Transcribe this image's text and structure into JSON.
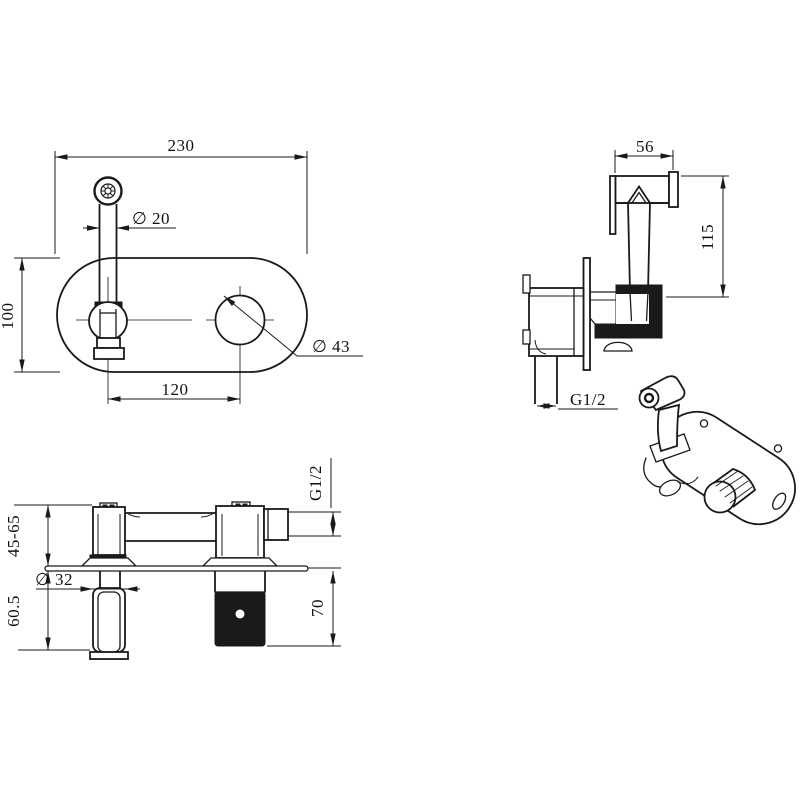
{
  "drawing": {
    "ink_color": "#1a1a1a",
    "background_color": "#ffffff",
    "views": {
      "plan": {
        "dim_width": "230",
        "dim_spout": "∅ 20",
        "dim_height": "100",
        "dim_hole": "∅ 43",
        "dim_spacing": "120"
      },
      "side": {
        "dim_head": "56",
        "dim_height": "115",
        "dim_thread": "G1/2"
      },
      "install": {
        "dim_thread": "G1/2",
        "dim_depth": "45-65",
        "dim_handle": "∅ 32",
        "dim_below": "60.5",
        "dim_box": "70"
      }
    }
  }
}
